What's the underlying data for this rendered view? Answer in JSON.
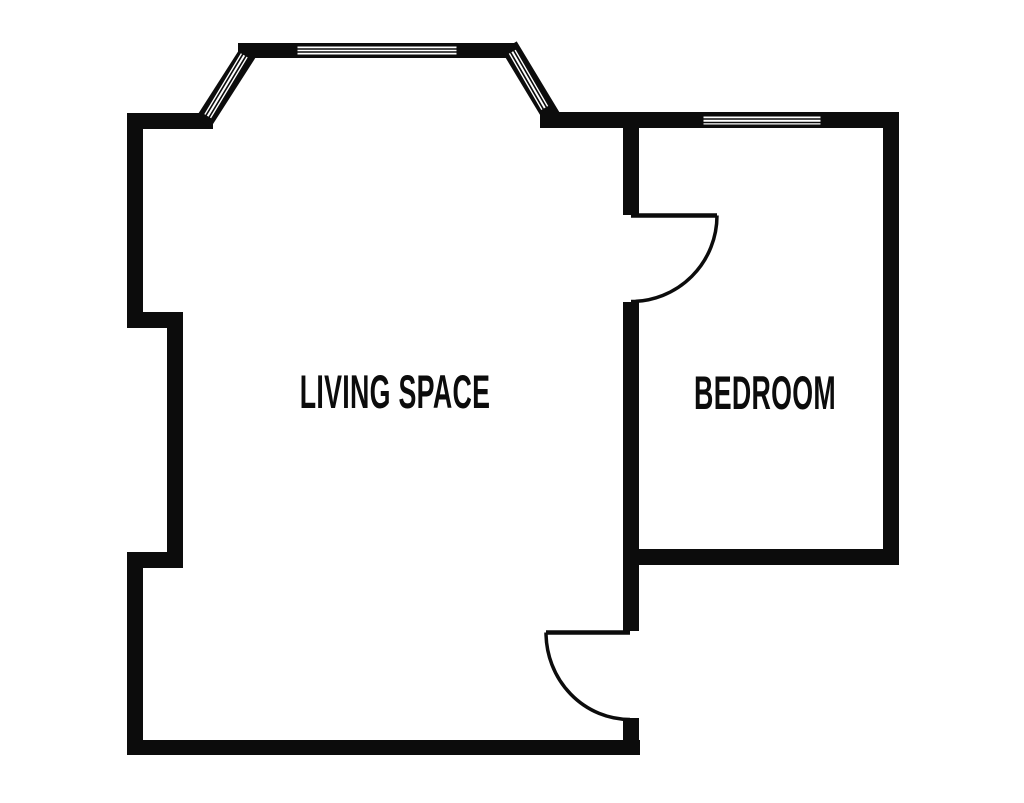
{
  "title": "Floor plan",
  "colors": {
    "wall": "#0c0c0c",
    "background": "#ffffff"
  },
  "rooms": [
    {
      "id": "living-space",
      "label": "LIVING SPACE"
    },
    {
      "id": "bedroom",
      "label": "BEDROOM"
    }
  ],
  "features": {
    "windows": [
      {
        "name": "bay-window-left-panel"
      },
      {
        "name": "bay-window-center-panel"
      },
      {
        "name": "bay-window-right-panel"
      },
      {
        "name": "bedroom-window"
      }
    ],
    "doors": [
      {
        "name": "bedroom-door"
      },
      {
        "name": "living-space-door"
      }
    ]
  }
}
